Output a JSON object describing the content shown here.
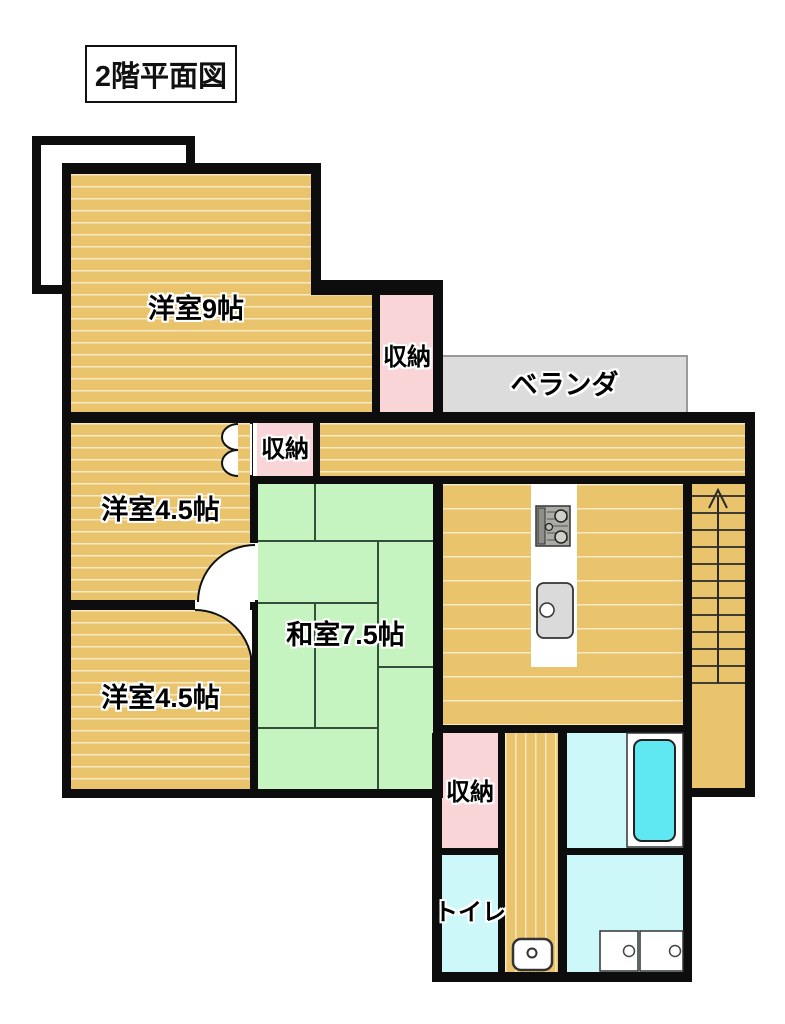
{
  "title": "2階平面図",
  "rooms": {
    "western9": "洋室9帖",
    "western45_upper": "洋室4.5帖",
    "western45_lower": "洋室4.5帖",
    "japanese75": "和室7.5帖",
    "storage_top": "収納",
    "storage_hall": "収納",
    "storage_bottom": "収納",
    "toilet": "トイレ",
    "veranda": "ベランダ"
  },
  "fixtures": [
    "stove",
    "kitchen-sink",
    "staircase-up-arrow",
    "closet-bifold-door",
    "door-swing",
    "toilet-bowl",
    "bathtub",
    "washer-pan",
    "laundry-units"
  ],
  "colors": {
    "wall": "#0d0d0d",
    "wood_floor": "#EAC46D",
    "wood_stripe": "#F7E9C2",
    "tatami_green": "#C6F4C1",
    "tatami_line": "#35503A",
    "storage_pink": "#FAD5D8",
    "wet_area_cyan": "#CDF8F9",
    "bathtub_cyan": "#5FE8F2",
    "veranda_gray": "#DCDCDC"
  }
}
